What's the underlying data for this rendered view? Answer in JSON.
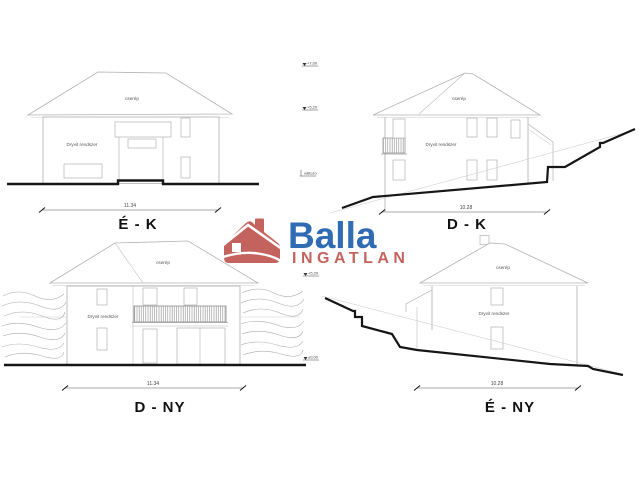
{
  "brand": {
    "name": "Balla",
    "type": "INGATLAN",
    "house_icon": "house-roof-chimney",
    "red": "#c4635e",
    "blue": "#2f6cb3"
  },
  "views": {
    "ek": {
      "label": "É - K",
      "dimension": "11.34",
      "roof_material": "cserép",
      "wall_material": "Dryvit rendszer"
    },
    "dk": {
      "label": "D - K",
      "dimension": "10.28",
      "roof_material": "cserép",
      "wall_material": "Dryvit rendszer"
    },
    "dny": {
      "label": "D - NY",
      "dimension": "11.34",
      "roof_material": "cserép",
      "wall_material": "Dryvit rendszer"
    },
    "eny": {
      "label": "É - NY",
      "dimension": "10.28",
      "roof_material": "cserép",
      "wall_material": "Dryvit rendszer"
    }
  },
  "level_markers": {
    "ridge": "+7,00",
    "eaves": "+5,20",
    "terrain": "változó",
    "dny_eaves": "+5,20",
    "dny_ground": "±0,00"
  }
}
